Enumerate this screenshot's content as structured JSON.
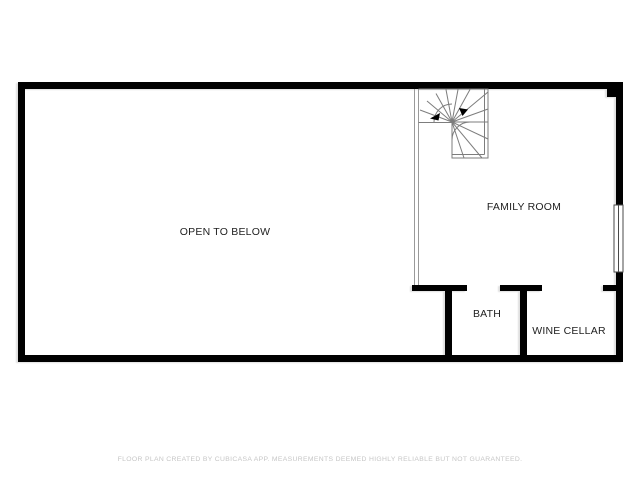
{
  "floor_plan": {
    "rooms": [
      {
        "id": "open-to-below",
        "label": "OPEN TO BELOW"
      },
      {
        "id": "family-room",
        "label": "FAMILY ROOM"
      },
      {
        "id": "bath",
        "label": "BATH"
      },
      {
        "id": "wine-cellar",
        "label": "WINE CELLAR"
      }
    ],
    "features": [
      {
        "id": "spiral-staircase",
        "type": "stairs"
      },
      {
        "id": "window-right-wall",
        "type": "window"
      },
      {
        "id": "railing-open-to-below",
        "type": "railing"
      }
    ],
    "colors": {
      "wall": "#000000",
      "stair_line": "#7d7d7d",
      "railing_line": "#9a9a9a",
      "label_text": "#1f1f1f",
      "background": "#ffffff"
    }
  },
  "footer": {
    "disclaimer": "FLOOR PLAN CREATED BY CUBICASA APP. MEASUREMENTS DEEMED HIGHLY RELIABLE BUT NOT GUARANTEED.",
    "color": "#c6c6c6"
  }
}
